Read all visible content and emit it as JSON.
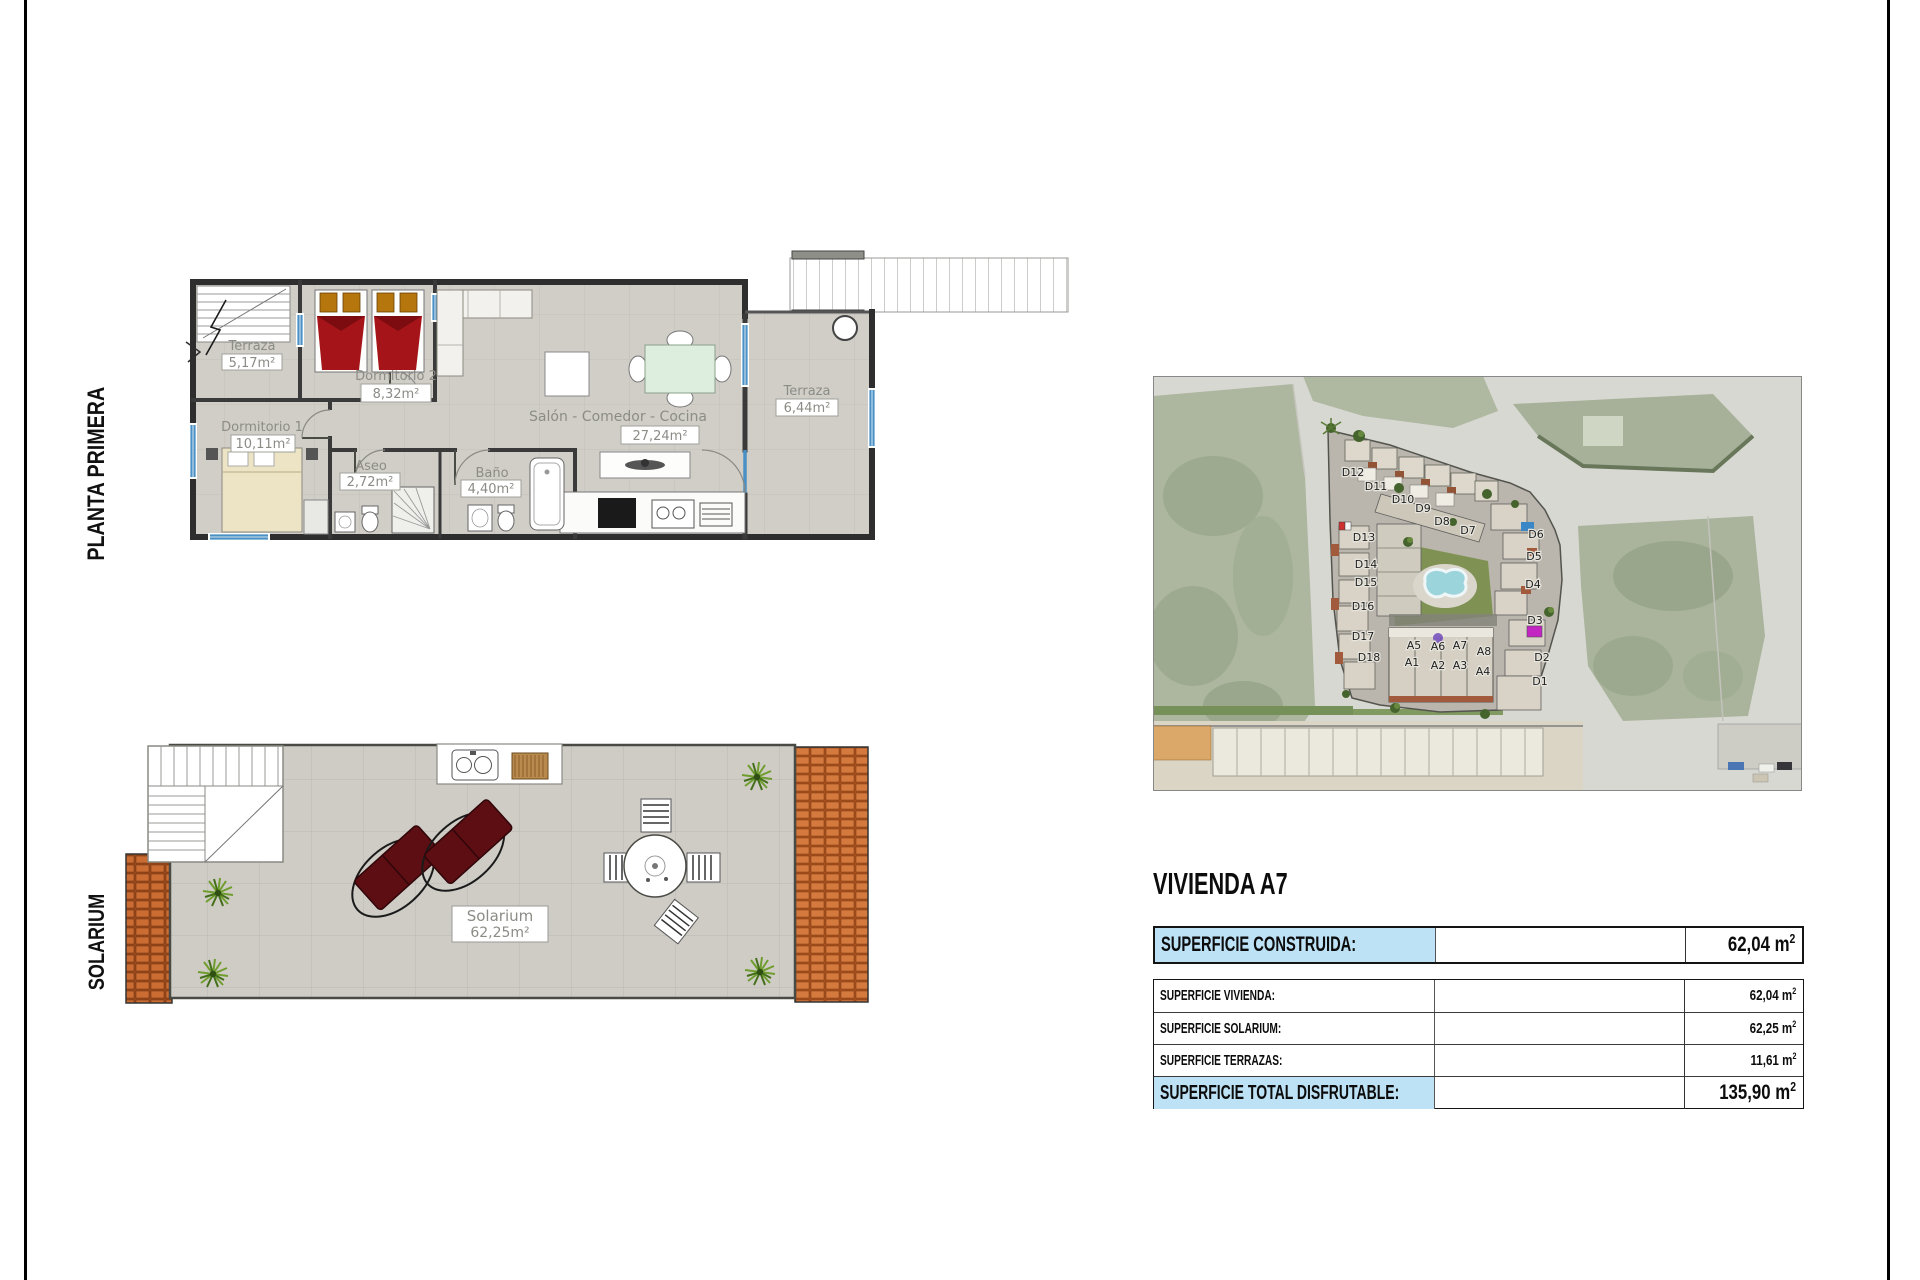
{
  "page": {
    "bg": "#ffffff",
    "frame_color": "#000000"
  },
  "side_labels": {
    "floor": "PLANTA PRIMERA",
    "roof": "SOLARIUM"
  },
  "floor_plan": {
    "terraza_izq": {
      "name": "Terraza",
      "area": "5,17m²"
    },
    "dormitorio2": {
      "name": "Dormitorio 2",
      "area": "8,32m²"
    },
    "dormitorio1": {
      "name": "Dormitorio 1",
      "area": "10,11m²"
    },
    "aseo": {
      "name": "Aseo",
      "area": "2,72m²"
    },
    "bano": {
      "name": "Baño",
      "area": "4,40m²"
    },
    "salon": {
      "name": "Salón - Comedor - Cocina",
      "area": "27,24m²"
    },
    "terraza_der": {
      "name": "Terraza",
      "area": "6,44m²"
    }
  },
  "solarium_plan": {
    "name": "Solarium",
    "area": "62,25m²"
  },
  "aerial": {
    "units": {
      "d12": "D12",
      "d11": "D11",
      "d10": "D10",
      "d9": "D9",
      "d8": "D8",
      "d7": "D7",
      "d13": "D13",
      "d14": "D14",
      "d15": "D15",
      "d16": "D16",
      "d17": "D17",
      "d18": "D18",
      "d6": "D6",
      "d5": "D5",
      "d4": "D4",
      "d3": "D3",
      "d2": "D2",
      "d1": "D1",
      "a5": "A5",
      "a6": "A6",
      "a7": "A7",
      "a8": "A8",
      "a1": "A1",
      "a2": "A2",
      "a3": "A3",
      "a4": "A4"
    }
  },
  "info": {
    "title": "VIVIENDA A7",
    "unit_base": "m",
    "unit_exp": "2",
    "construida": {
      "label": "SUPERFICIE CONSTRUIDA:",
      "value": "62,04"
    },
    "vivienda": {
      "label": "SUPERFICIE VIVIENDA:",
      "value": "62,04"
    },
    "solarium": {
      "label": "SUPERFICIE SOLARIUM:",
      "value": "62,25"
    },
    "terrazas": {
      "label": "SUPERFICIE TERRAZAS:",
      "value": "11,61"
    },
    "total": {
      "label": "SUPERFICIE TOTAL DISFRUTABLE:",
      "value": "135,90"
    }
  },
  "colors": {
    "highlight": "#bde1f5",
    "bed_red": "#a51418",
    "roof_tile": "#c2622a",
    "pool": "#96d2da",
    "window_blue": "#4a90c4"
  }
}
